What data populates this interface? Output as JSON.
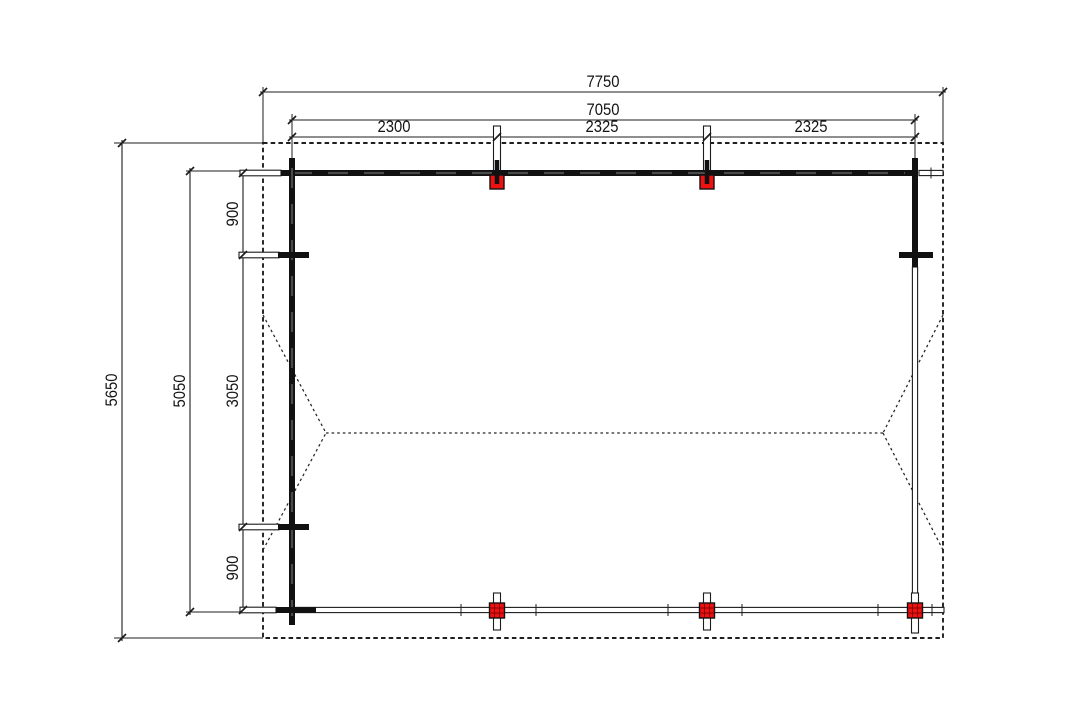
{
  "dims": {
    "roof_width": "7750",
    "frame_width": "7050",
    "bays": [
      "2300",
      "2325",
      "2325"
    ],
    "roof_depth": "5650",
    "frame_depth": "5050",
    "depth_segments": [
      "900",
      "3050",
      "900"
    ]
  },
  "colors": {
    "line": "#1c1c1c",
    "post_fill": "#ee1111",
    "post_grid": "#8a0000",
    "background": "#ffffff"
  }
}
